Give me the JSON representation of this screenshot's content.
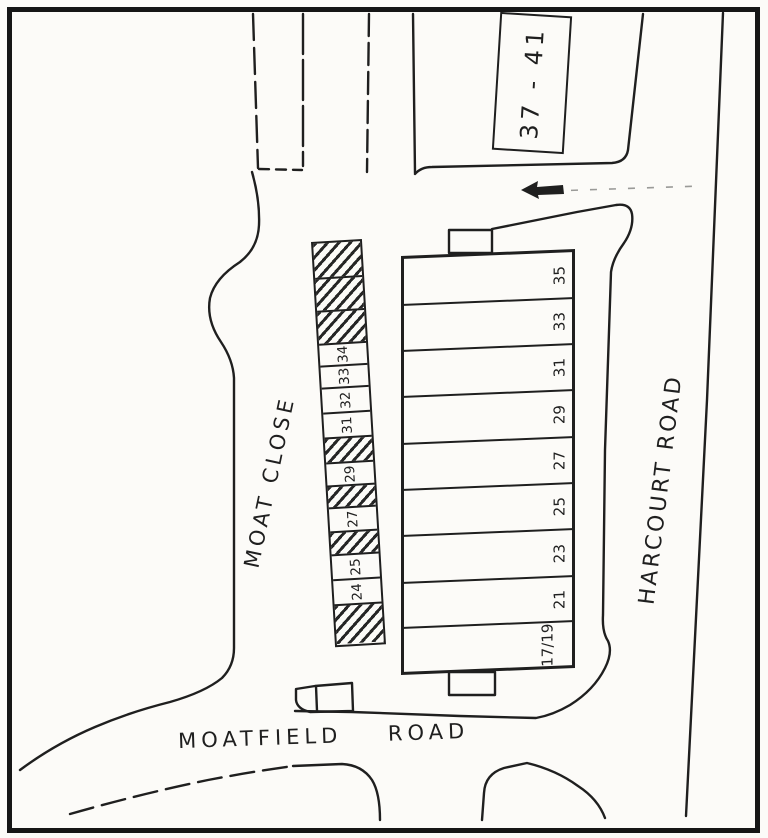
{
  "map": {
    "type": "hand-drawn site plan",
    "colors": {
      "ink": "#1f1f1f",
      "paper": "#fcfbf8"
    }
  },
  "labels": {
    "building_37_41": "37 - 41",
    "moat_close": "MOAT CLOSE",
    "harcourt_road": "HARCOURT ROAD",
    "moatfield_road": "MOATFIELD ROAD"
  },
  "terrace_plots": {
    "description": "row of nine plots fronting Harcourt Road, numbered top to bottom",
    "labels": [
      "35",
      "33",
      "31",
      "29",
      "27",
      "25",
      "23",
      "21",
      "17/19"
    ]
  },
  "moat_strip": {
    "description": "strip of small plots along Moat Close; hatched cells are unnumbered",
    "cells": [
      {
        "type": "hatched"
      },
      {
        "type": "hatched"
      },
      {
        "type": "hatched"
      },
      {
        "type": "numbered",
        "label": "34"
      },
      {
        "type": "numbered",
        "label": "33"
      },
      {
        "type": "numbered",
        "label": "32"
      },
      {
        "type": "numbered",
        "label": "31"
      },
      {
        "type": "hatched"
      },
      {
        "type": "numbered",
        "label": "29"
      },
      {
        "type": "hatched"
      },
      {
        "type": "numbered",
        "label": "27"
      },
      {
        "type": "hatched"
      },
      {
        "type": "numbered",
        "label": "25"
      },
      {
        "type": "numbered",
        "label": "24"
      },
      {
        "type": "hatched"
      }
    ]
  },
  "icons": {
    "one_way_arrow": "left-pointing road arrow"
  }
}
